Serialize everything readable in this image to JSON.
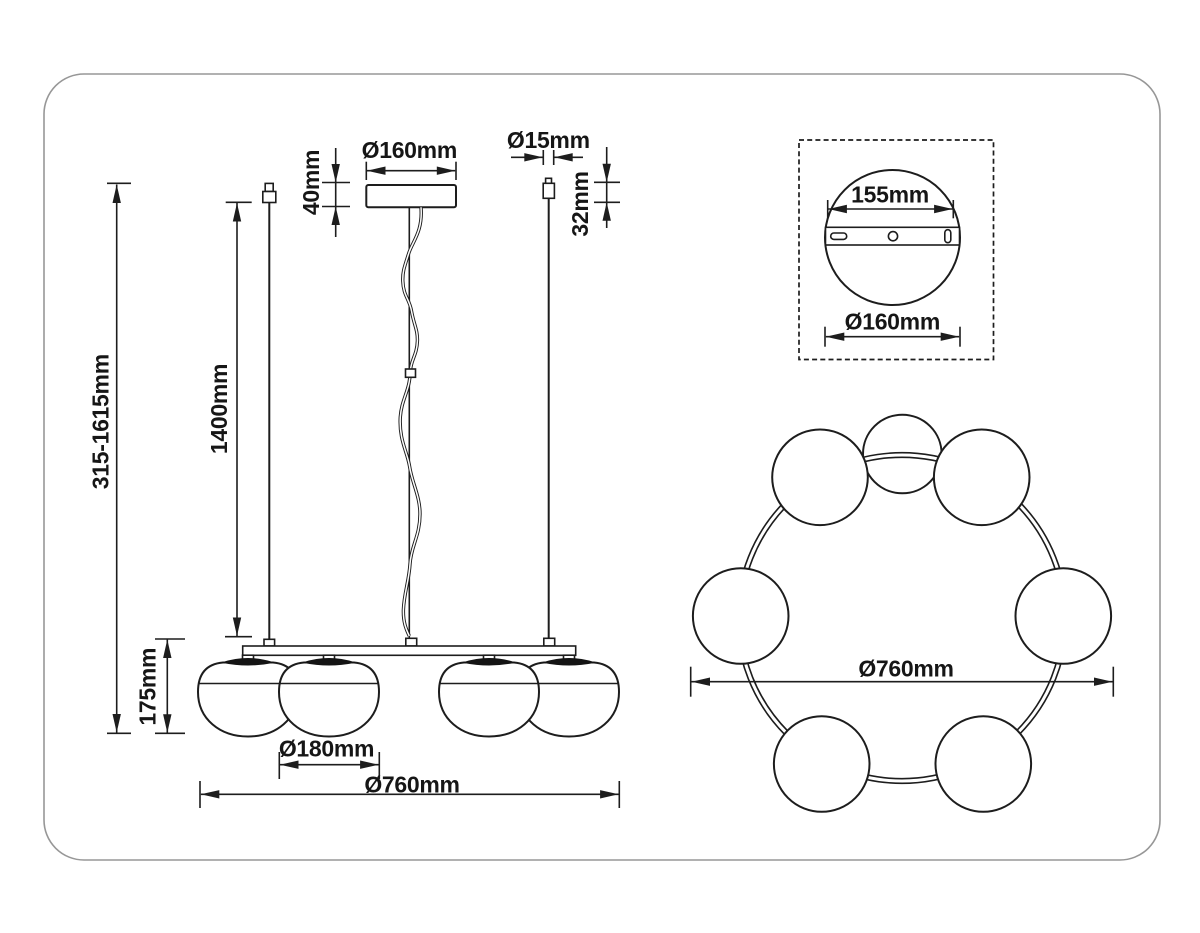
{
  "drawing": {
    "front_view": {
      "overall_height": "315-1615mm",
      "cable_length": "1400mm",
      "canopy_height": "40mm",
      "canopy_diameter": "Ø160mm",
      "suspension_wire_diameter": "Ø15mm",
      "wire_connector_height": "32mm",
      "shade_height": "175mm",
      "shade_diameter": "Ø180mm",
      "overall_diameter": "Ø760mm"
    },
    "mount": {
      "bracket_width": "155mm",
      "plate_diameter": "Ø160mm"
    },
    "top_view": {
      "overall_diameter": "Ø760mm"
    },
    "colors": {
      "line": "#1d1d1d",
      "frame": "#979797",
      "background": "#ffffff"
    }
  }
}
